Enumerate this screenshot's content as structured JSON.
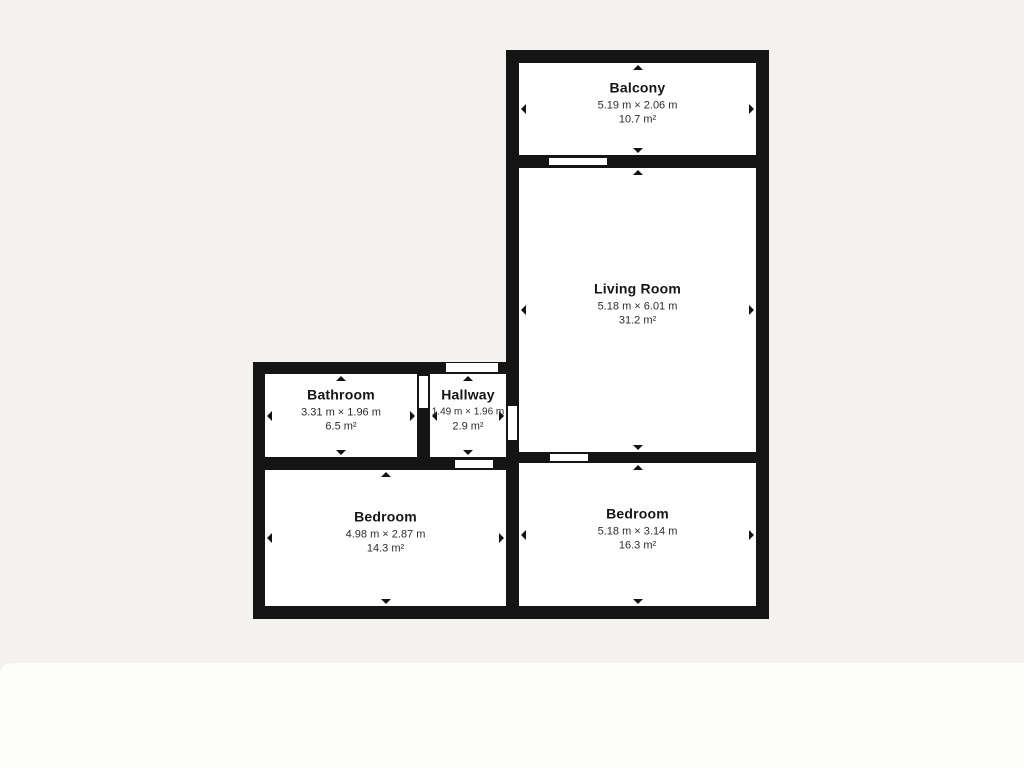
{
  "colors": {
    "wall": "#141414",
    "room_fill": "#fefefe",
    "background": "#f3f2ee",
    "panel": "#fdfdfb",
    "text_primary": "#161616",
    "text_secondary": "#2e2e2e"
  },
  "floorplan": {
    "rooms": [
      {
        "id": "balcony",
        "name": "Balcony",
        "dimensions": "5.19 m × 2.06 m",
        "area": "10.7 m²"
      },
      {
        "id": "living-room",
        "name": "Living Room",
        "dimensions": "5.18 m × 6.01 m",
        "area": "31.2 m²"
      },
      {
        "id": "bathroom",
        "name": "Bathroom",
        "dimensions": "3.31 m × 1.96 m",
        "area": "6.5 m²"
      },
      {
        "id": "hallway",
        "name": "Hallway",
        "dimensions": "1.49 m × 1.96 m",
        "area": "2.9 m²"
      },
      {
        "id": "bedroom-left",
        "name": "Bedroom",
        "dimensions": "4.98 m × 2.87 m",
        "area": "14.3 m²"
      },
      {
        "id": "bedroom-right",
        "name": "Bedroom",
        "dimensions": "5.18 m × 3.14 m",
        "area": "16.3 m²"
      }
    ]
  }
}
